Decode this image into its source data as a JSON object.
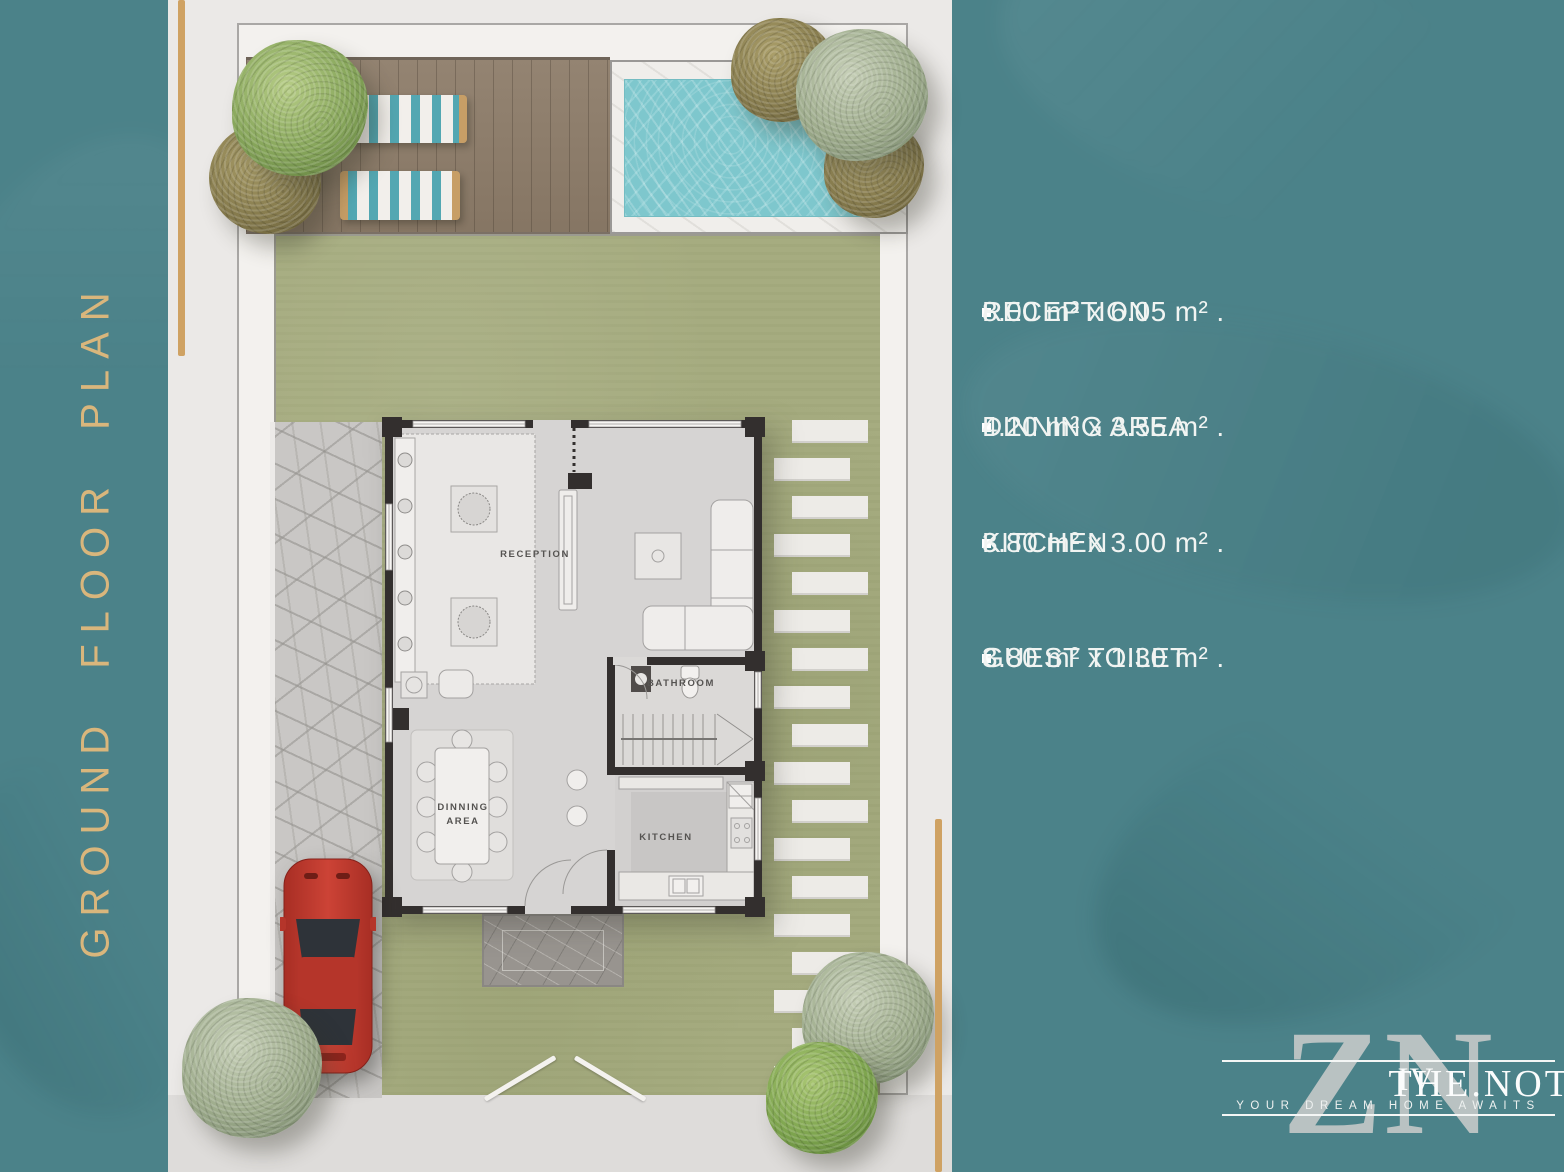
{
  "title_vertical": "GROUND FLOOR PLAN",
  "specs": [
    {
      "label": "RECEPTION",
      "value": "8.00 m² x 6.05 m² ."
    },
    {
      "label": "DINNING AREA",
      "value": "4.20 m² x 3.55 m² ."
    },
    {
      "label": "KITCHEN",
      "value": "3.80 m² x 3.00 m² ."
    },
    {
      "label": "GUEST TOILET",
      "value": "3.80 m² x 1.30 m² ."
    }
  ],
  "plan": {
    "labels": {
      "reception": "RECEPTION",
      "bathroom": "BATHROOM",
      "dinning_line1": "DINNING",
      "dinning_line2": "AREA",
      "kitchen": "KITCHEN"
    }
  },
  "logo": {
    "monogram": "ZN",
    "name": "THE.NOTCH",
    "numeral": "IV",
    "tagline": "YOUR DREAM HOME AWAITS"
  },
  "colors": {
    "teal": "#4b8289",
    "page": "#ebe9e7",
    "gold": "#cfa263",
    "gold_text": "#d9b67c",
    "lawn": "#a6ac80",
    "deck": "#8d7c69",
    "pool": "#7ec7cd",
    "stone": "#c9c7c5",
    "wall": "#332f2e",
    "car": "#c23a2f",
    "text": "#f1f4f2"
  }
}
